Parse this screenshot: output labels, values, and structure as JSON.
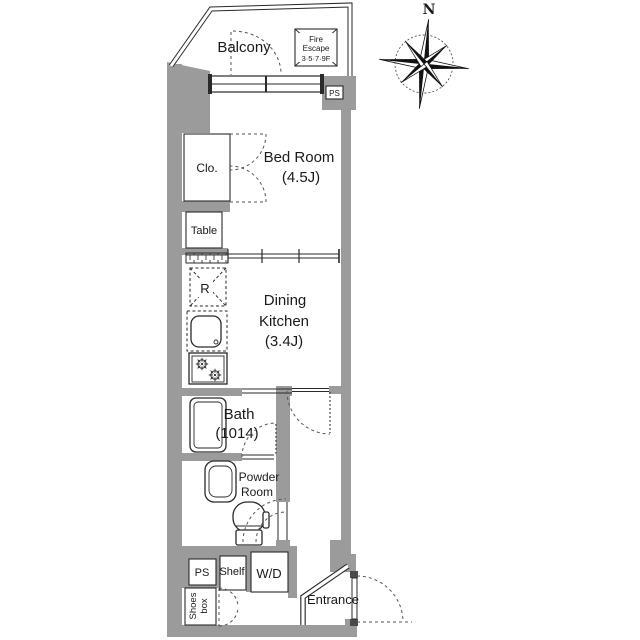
{
  "compass": {
    "north": "N"
  },
  "rooms": {
    "balcony": {
      "label": "Balcony"
    },
    "fire_escape": {
      "line1": "Fire",
      "line2": "Escape",
      "line3": "3·5·7·9F"
    },
    "ps_top": {
      "label": "PS"
    },
    "bedroom": {
      "label": "Bed Room",
      "size": "(4.5J)"
    },
    "closet": {
      "label": "Clo."
    },
    "table": {
      "label": "Table"
    },
    "fridge": {
      "label": "R"
    },
    "dining_kitchen": {
      "line1": "Dining",
      "line2": "Kitchen",
      "size": "(3.4J)"
    },
    "bath": {
      "label": "Bath",
      "size": "(1014)"
    },
    "powder_room": {
      "line1": "Powder",
      "line2": "Room"
    },
    "ps_bottom": {
      "label": "PS"
    },
    "shelf": {
      "label": "Shelf"
    },
    "washer_dryer": {
      "label": "W/D"
    },
    "shoes_box": {
      "line1": "Shoes",
      "line2": "box"
    },
    "entrance": {
      "label": "Entrance"
    }
  },
  "colors": {
    "wall": "#9b9b9b",
    "line": "#2a2a2a",
    "background": "#ffffff"
  }
}
